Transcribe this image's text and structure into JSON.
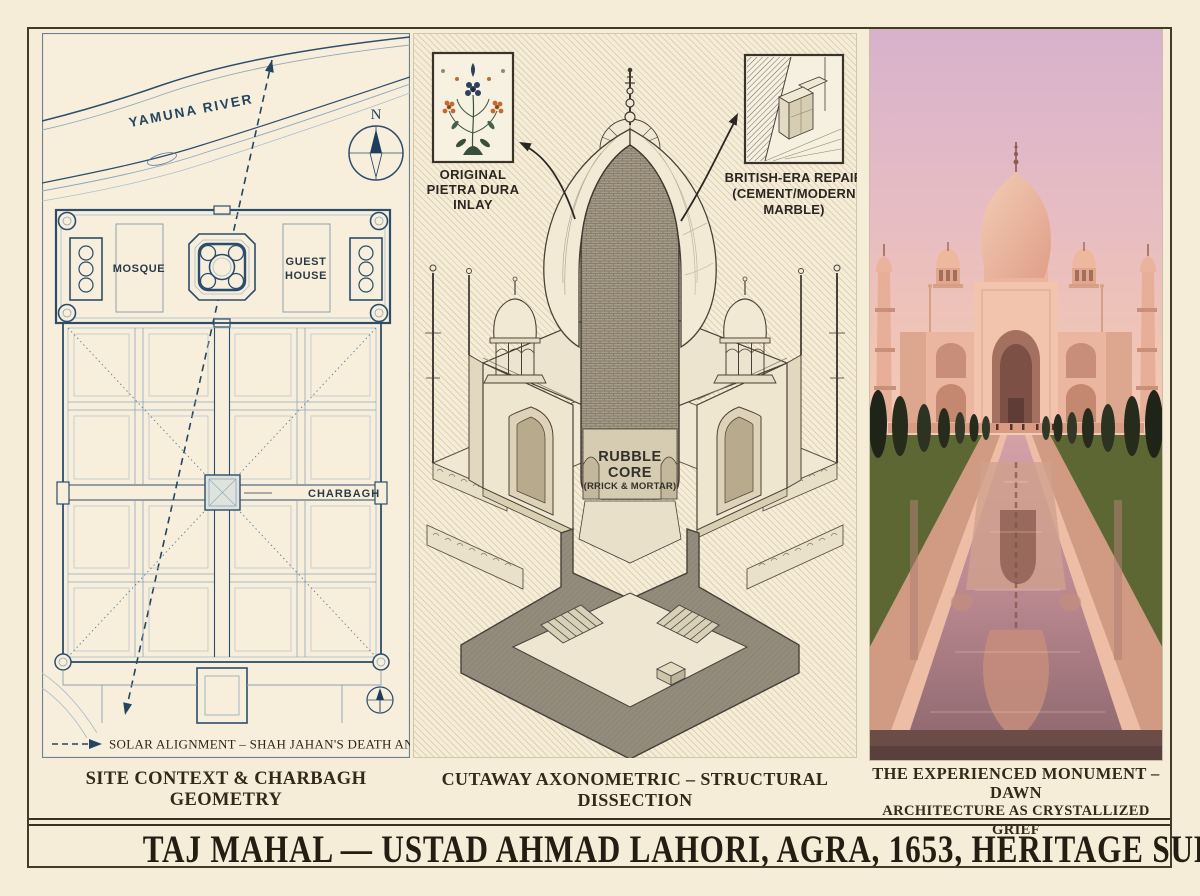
{
  "poster": {
    "title": "TAJ MAHAL — USTAD AHMAD LAHORI, AGRA, 1653, HERITAGE SURVEY"
  },
  "site_panel": {
    "caption": "SITE CONTEXT & CHARBAGH GEOMETRY",
    "river_label": "YAMUNA RIVER",
    "compass_north": "N",
    "mosque_label": "MOSQUE",
    "guest_house_lines": [
      "GUEST",
      "HOUSE"
    ],
    "charbagh_label": "CHARBAGH",
    "legend_text": "SOLAR ALIGNMENT – SHAH JAHAN'S DEATH ANNIVERSARY"
  },
  "cutaway_panel": {
    "caption": "CUTAWAY AXONOMETRIC – STRUCTURAL DISSECTION",
    "inlay_callout_lines": [
      "ORIGINAL",
      "PIETRA DURA",
      "INLAY"
    ],
    "repair_callout_lines": [
      "BRITISH-ERA REPAIR",
      "(CEMENT/MODERN",
      "MARBLE)"
    ],
    "core_label_lines": [
      "RUBBLE",
      "CORE",
      "(RRICK & MORTAR)"
    ]
  },
  "photo_panel": {
    "caption_lines": [
      "THE EXPERIENCED MONUMENT – DAWN",
      "ARCHITECTURE AS CRYSTALLIZED GRIEF"
    ]
  },
  "colors": {
    "paper": "#f6edd8",
    "frame_ink": "#453a28",
    "blueprint_dark": "#2c4d6b",
    "blueprint_light": "#9fb2c2",
    "caption_ink": "#33291a",
    "drawing_ink": "#45403a",
    "section_grey": "#938b7b",
    "dawn_sky_top": "#d7b2cc",
    "dawn_sky_horizon": "#f3cab6",
    "monument_pink": "#ecb79f",
    "water_mauve": "#b9888f",
    "cypress_green": "#262b1c"
  }
}
